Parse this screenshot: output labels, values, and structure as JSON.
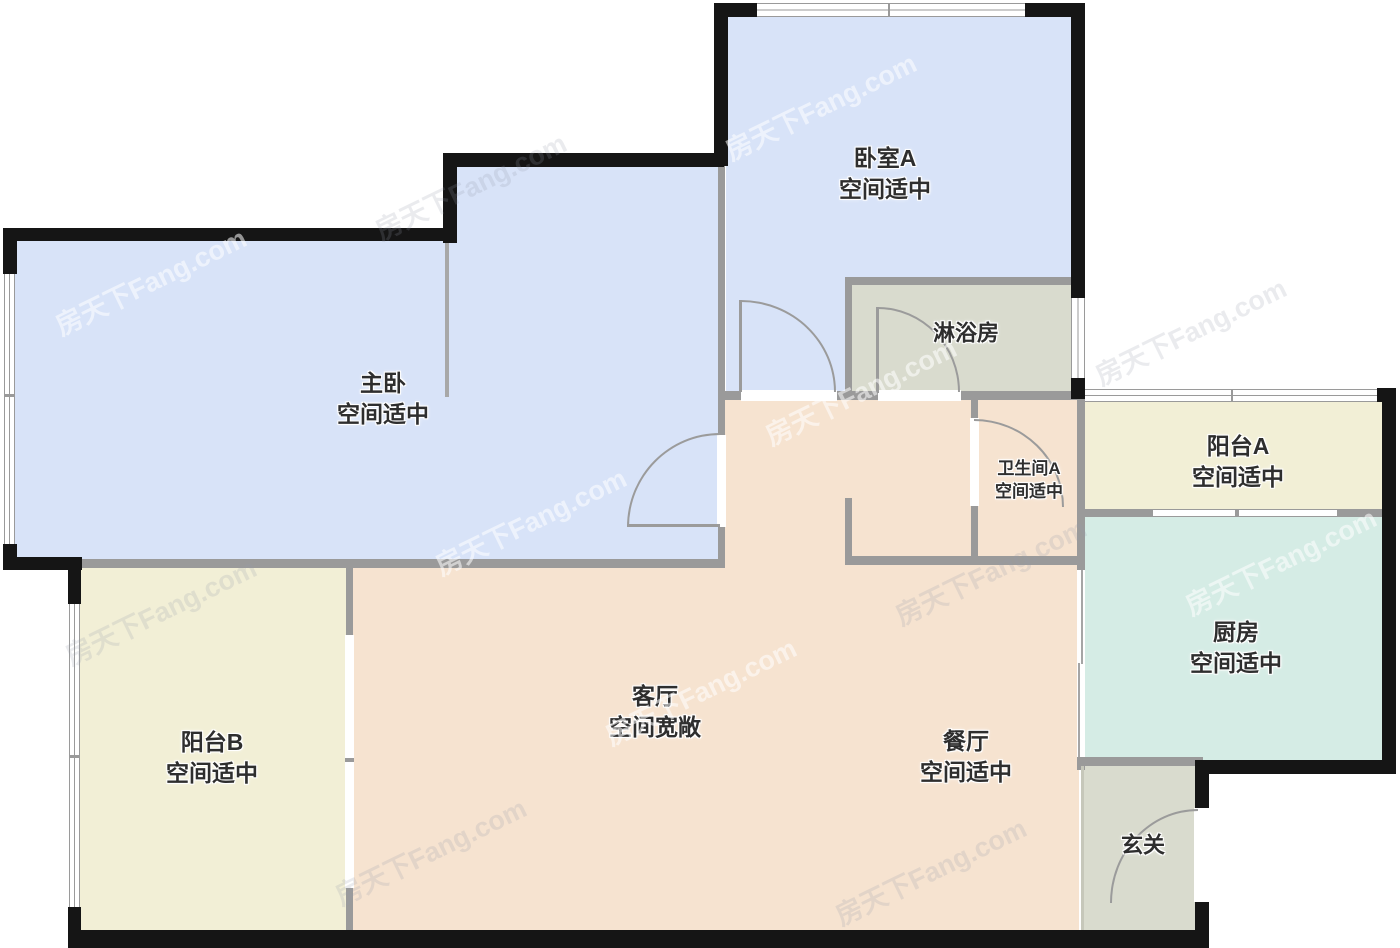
{
  "watermark": "房天下Fang.com",
  "rooms": {
    "bedroomA": {
      "name": "卧室A",
      "size": "空间适中"
    },
    "master": {
      "name": "主卧",
      "size": "空间适中"
    },
    "shower": {
      "name": "淋浴房"
    },
    "bathroomA": {
      "name": "卫生间A",
      "size": "空间适中"
    },
    "balconyA": {
      "name": "阳台A",
      "size": "空间适中"
    },
    "kitchen": {
      "name": "厨房",
      "size": "空间适中"
    },
    "living": {
      "name": "客厅",
      "size": "空间宽敞"
    },
    "dining": {
      "name": "餐厅",
      "size": "空间适中"
    },
    "balconyB": {
      "name": "阳台B",
      "size": "空间适中"
    },
    "foyer": {
      "name": "玄关"
    }
  },
  "colors": {
    "bedroom_fill": "#d8e3f8",
    "living_fill": "#f6e3d0",
    "balcony_fill": "#f2efd6",
    "wet_fill": "#d5ece5",
    "service_fill": "#d9dbce",
    "interior_wall": "#9a9a9a",
    "outer_wall": "#151515"
  }
}
